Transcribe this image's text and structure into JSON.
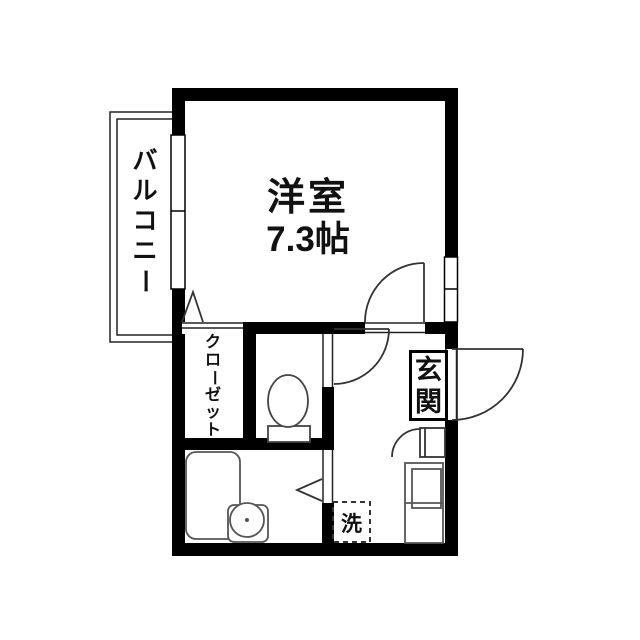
{
  "plan": {
    "type": "apartment-floor-plan",
    "rooms": {
      "main_room": {
        "name": "洋室",
        "size": "7.3帖"
      },
      "balcony": {
        "label": "バルコニー",
        "chars": [
          "バ",
          "ル",
          "コ",
          "ニ",
          "ー"
        ]
      },
      "closet": {
        "label": "クローゼット",
        "chars": [
          "ク",
          "ロ",
          "ー",
          "ゼ",
          "ッ",
          "ト"
        ]
      },
      "entrance": {
        "label": "玄関",
        "chars": [
          "玄",
          "関"
        ]
      },
      "washer_space": {
        "label": "洗"
      }
    },
    "fixtures": [
      "toilet",
      "bathtub",
      "washbasin",
      "kitchen-unit",
      "shoe-cabinet",
      "washing-machine-space",
      "entrance-door",
      "main-room-door",
      "toilet-door",
      "bathroom-folding-door",
      "balcony-window",
      "side-window"
    ],
    "colors": {
      "wall": "#000000",
      "fixture_line": "#555555",
      "door_line": "#333333",
      "background": "#ffffff",
      "text": "#111111"
    }
  }
}
